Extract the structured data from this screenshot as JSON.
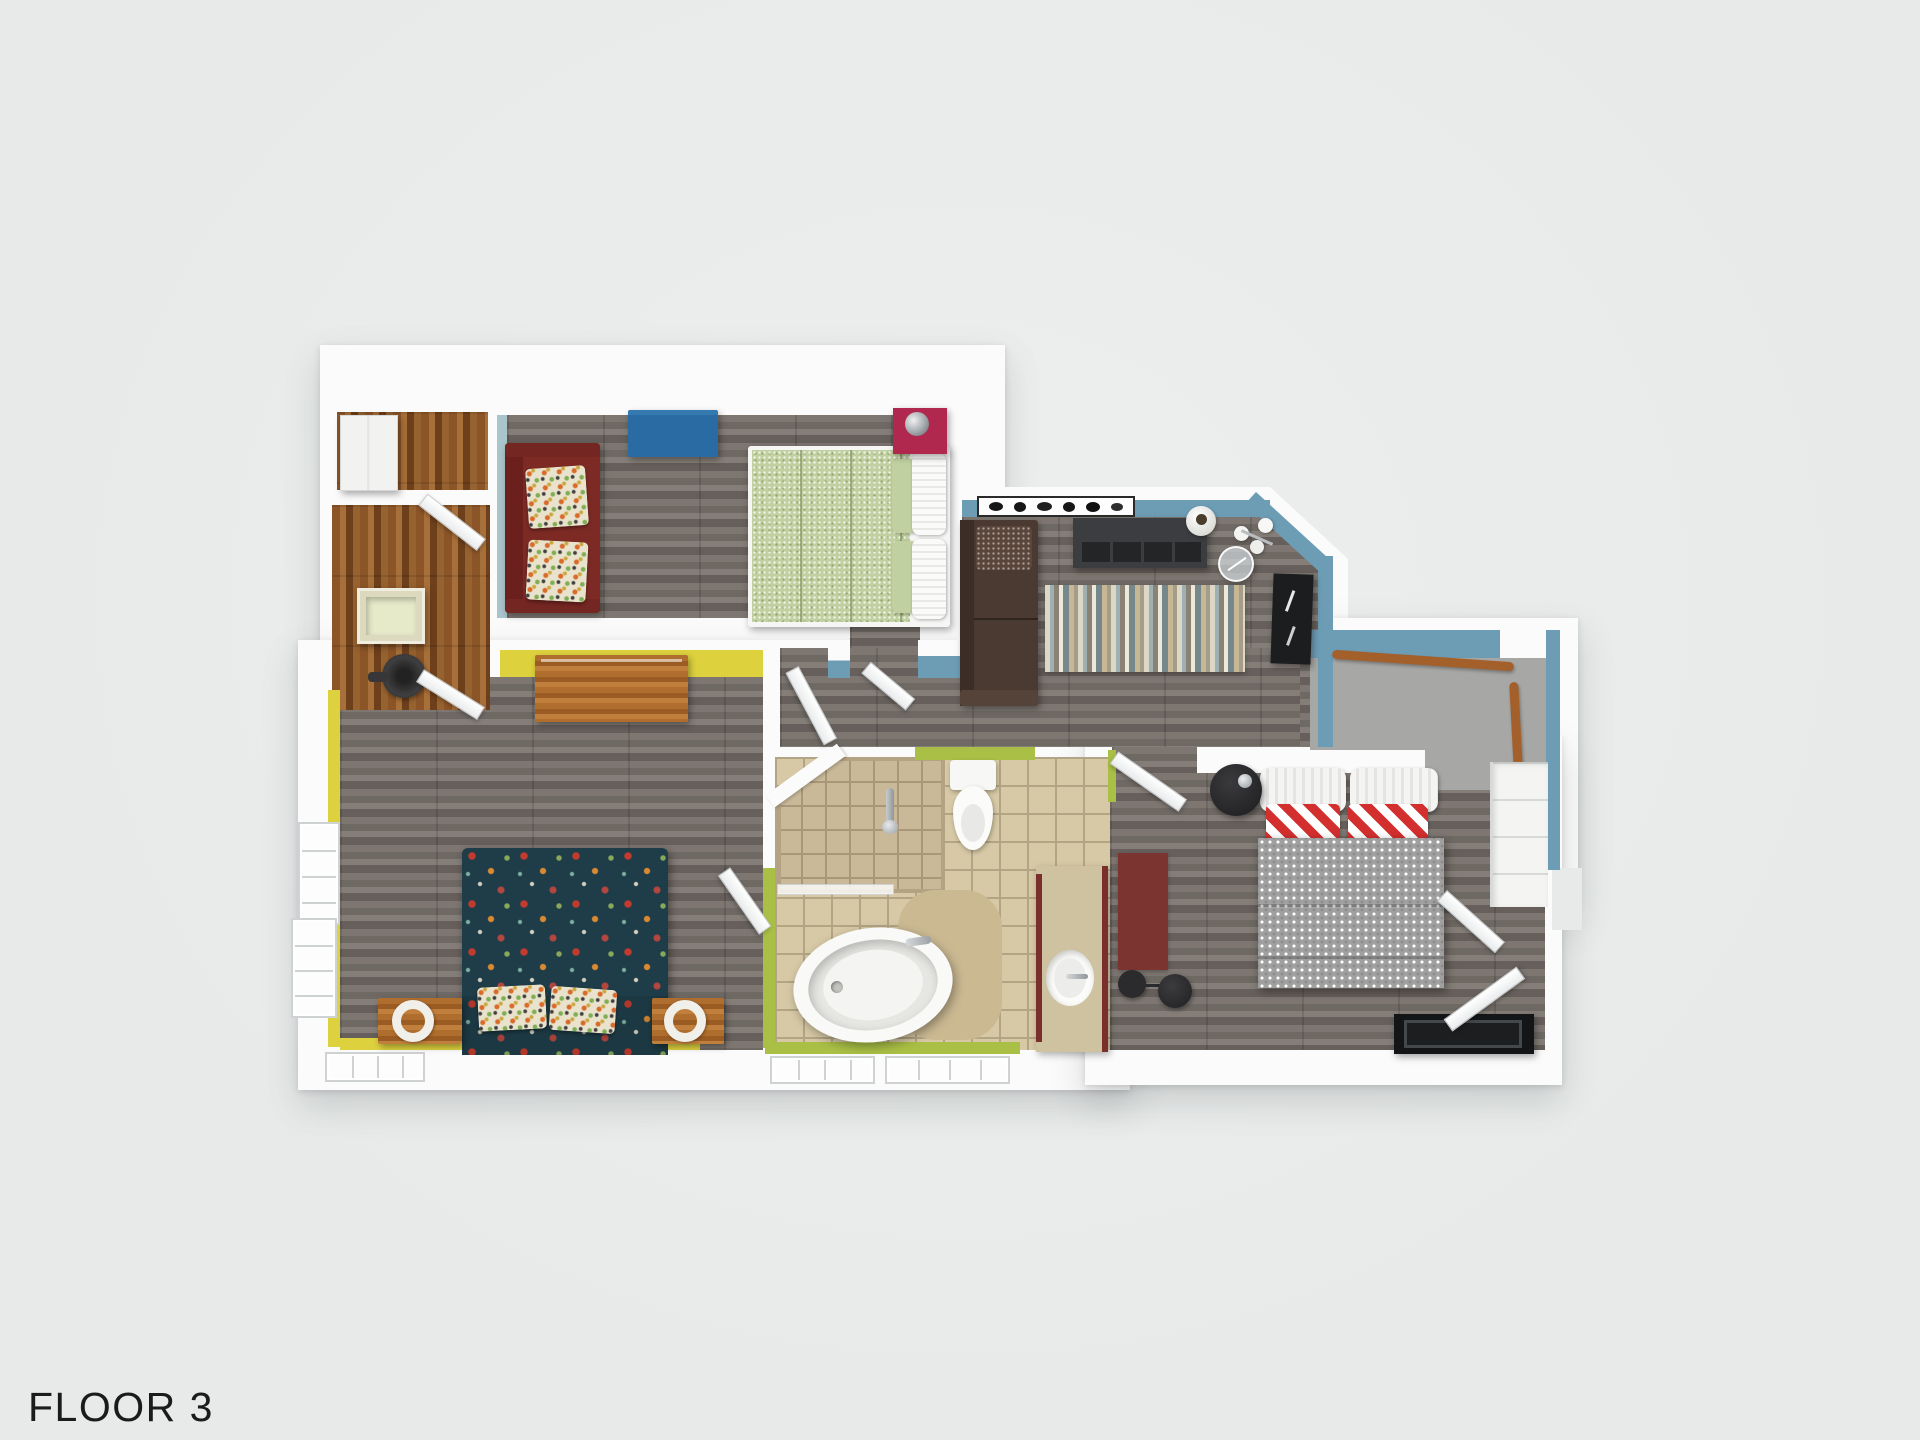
{
  "title": {
    "text": "FLOOR 3"
  },
  "palette": {
    "background": "#e8eaea",
    "label": "#1b1b1b",
    "wall": "#fbfbfb",
    "wall_shadow": "#d9dbdc",
    "blue_wall": "#6d9db5",
    "pale_blue_wall": "#a9c4cb",
    "yellow_wall": "#ddd13e",
    "green_wall": "#a9bf45",
    "gray_wood": "#76706c",
    "gray_wood_dark": "#665f5b",
    "gray_wood_light": "#857e78",
    "warm_wood": "#8c5527",
    "warm_wood_dark": "#6d3f1b",
    "warm_wood_light": "#a76f39",
    "tile": "#d7c9a6",
    "tile_grout": "#b3a584",
    "shower_tile": "#c9b999",
    "carpet": "#a7a7a5",
    "carpet_line": "#8e8e8c",
    "handrail": "#a4602b",
    "rug_a": "#ddd8c6",
    "rug_b": "#9fb0b2",
    "rug_c": "#8a8274",
    "rug_d": "#ece8da",
    "rug_e": "#77888d",
    "rug_f": "#c7b794",
    "red_couch": "#7d2a25",
    "brown_couch": "#4b3a31",
    "blue_ottoman": "#2a6ba3",
    "crimson_stand": "#b0284e",
    "green_bed": "#c0d0a0",
    "floral_bed": "#1e3d48",
    "gray_bed": "#a0a0a0",
    "stripe_red": "#d32f2f",
    "maroon_rug": "#7c3431",
    "furniture_wood": "#b06e2e",
    "dark_shelf": "#3b3d40",
    "black": "#1c1d1f",
    "white_fixture": "#f6f6f4"
  },
  "rooms": [
    {
      "id": "closet-top-left",
      "floor": "warm-wood"
    },
    {
      "id": "bedroom-top",
      "floor": "gray-wood",
      "accent": "pale-blue"
    },
    {
      "id": "living-area",
      "floor": "gray-wood",
      "accent": "blue"
    },
    {
      "id": "stairwell",
      "floor": "carpet",
      "accent": "blue"
    },
    {
      "id": "bedroom-right",
      "floor": "gray-wood",
      "accent": "blue"
    },
    {
      "id": "bathroom",
      "floor": "tile",
      "accent": "green"
    },
    {
      "id": "bedroom-bottom-left",
      "floor": "gray-wood",
      "accent": "yellow"
    }
  ]
}
